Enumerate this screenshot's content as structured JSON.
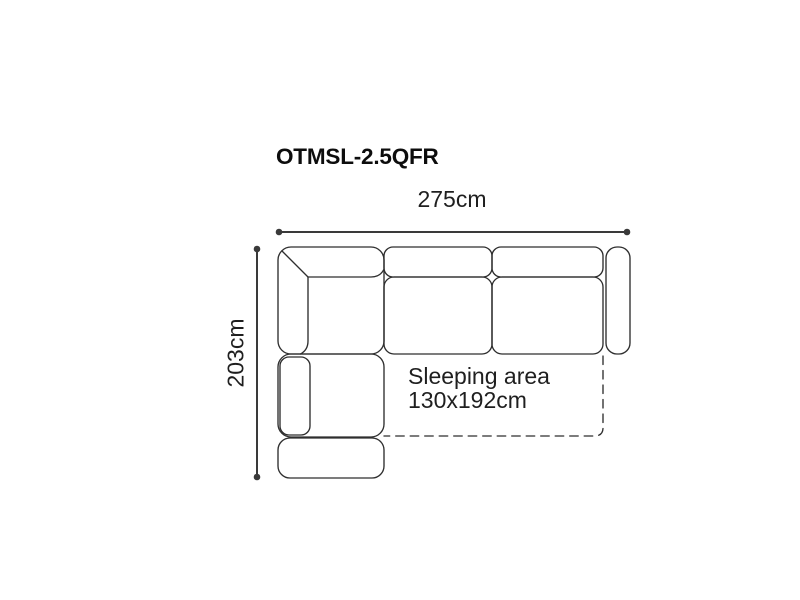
{
  "diagram": {
    "title": "OTMSL-2.5QFR",
    "dimensions": {
      "width": "275cm",
      "depth": "203cm"
    },
    "sleeping_area": {
      "line1": "Sleeping area",
      "line2": "130x192cm"
    },
    "colors": {
      "background": "#ffffff",
      "sofa_outline": "#2f2f2f",
      "dimension_line": "#3a3a3a",
      "text": "#1f1f1f",
      "title_text": "#0d0d0d"
    }
  }
}
